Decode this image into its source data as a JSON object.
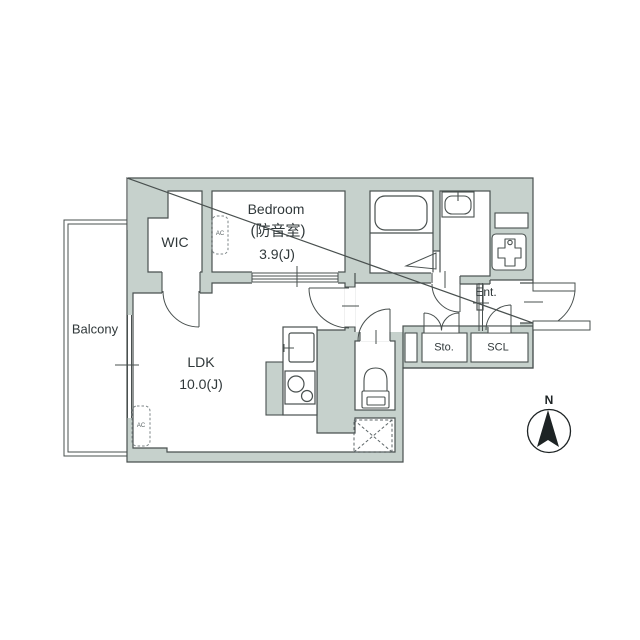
{
  "title": "Apartment floor plan",
  "rooms": {
    "balcony": {
      "label": "Balcony"
    },
    "wic": {
      "label": "WIC"
    },
    "bedroom": {
      "label": "Bedroom",
      "sublabel": "(防音室)",
      "size": "3.9(J)"
    },
    "ldk": {
      "label": "LDK",
      "size": "10.0(J)"
    },
    "entrance": {
      "label": "Ent."
    },
    "storage": {
      "label": "Sto."
    },
    "shoe_closet": {
      "label": "SCL"
    }
  },
  "annotations": {
    "ac_unit": "AC",
    "compass_north": "N"
  },
  "fixtures": [
    "bathtub",
    "washbasin",
    "washing-machine-pan",
    "toilet",
    "kitchen-sink",
    "stove",
    "utility-cabinet",
    "pipe-space-cross"
  ],
  "colors": {
    "wall_fill": "#c6d1cc",
    "outline": "#49504f",
    "text": "#30383a",
    "background": "#ffffff"
  }
}
